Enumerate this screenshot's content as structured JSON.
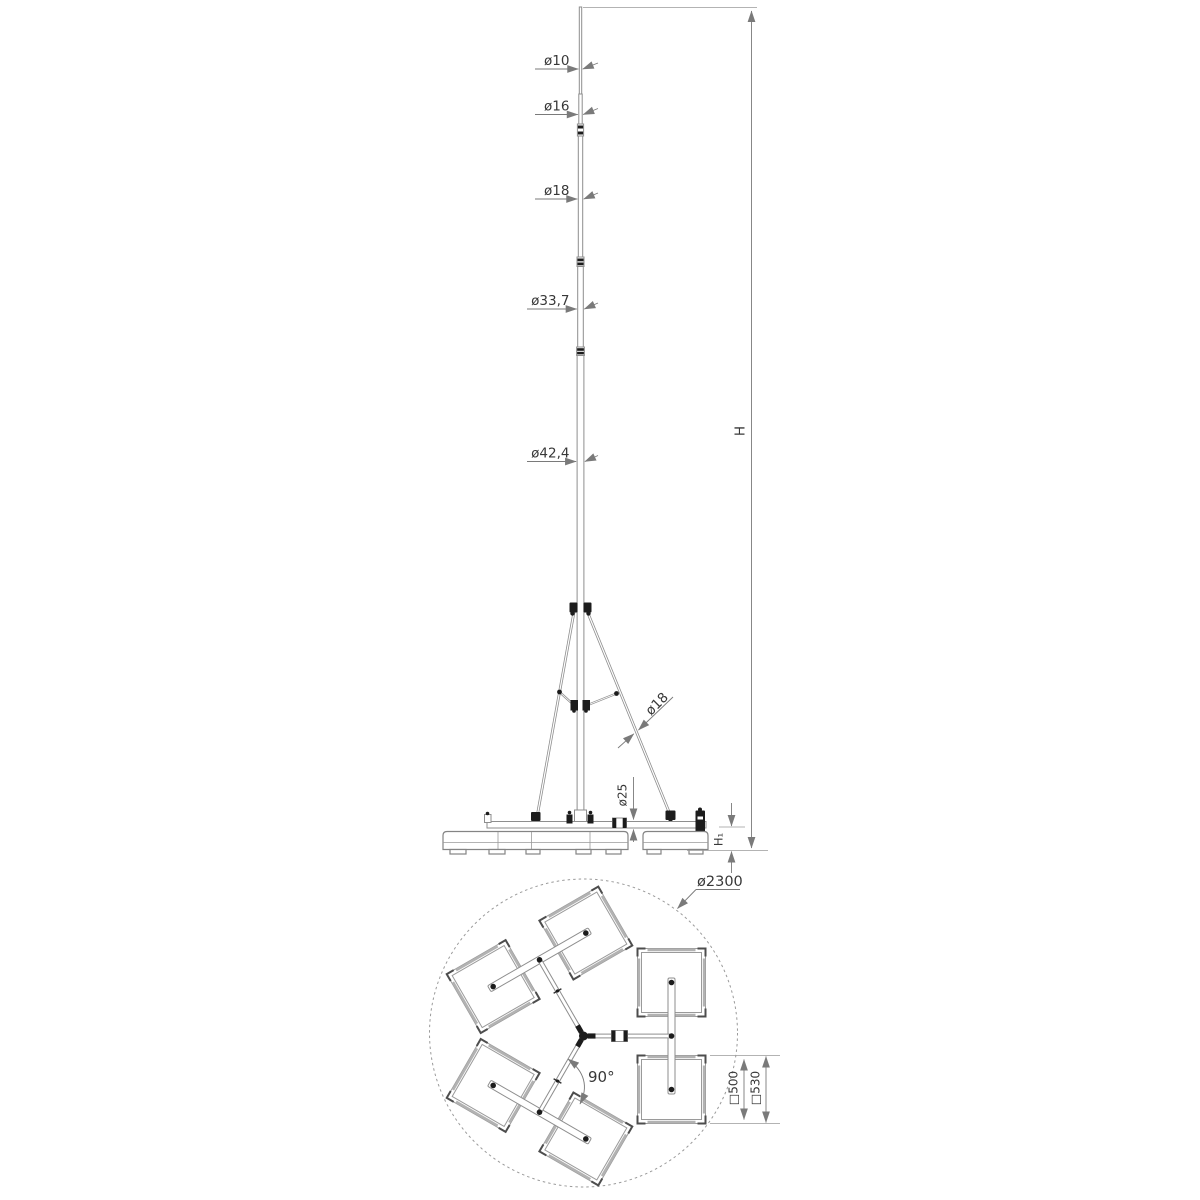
{
  "labels": {
    "mast_callouts": [
      "ø10",
      "ø16",
      "ø18",
      "ø33,7",
      "ø42,4"
    ],
    "leg_diameter": "ø18",
    "beam_diameter": "ø25",
    "total_height": "H",
    "base_height": "H₁",
    "plan": {
      "circle_diameter": "ø2300",
      "angle": "90°",
      "plate_inner": "□500",
      "plate_outer": "□530"
    }
  },
  "colors": {
    "line": "#8e8e8e",
    "dark_fitting": "#1c1c1c",
    "text": "#383838",
    "background": "#ffffff"
  }
}
